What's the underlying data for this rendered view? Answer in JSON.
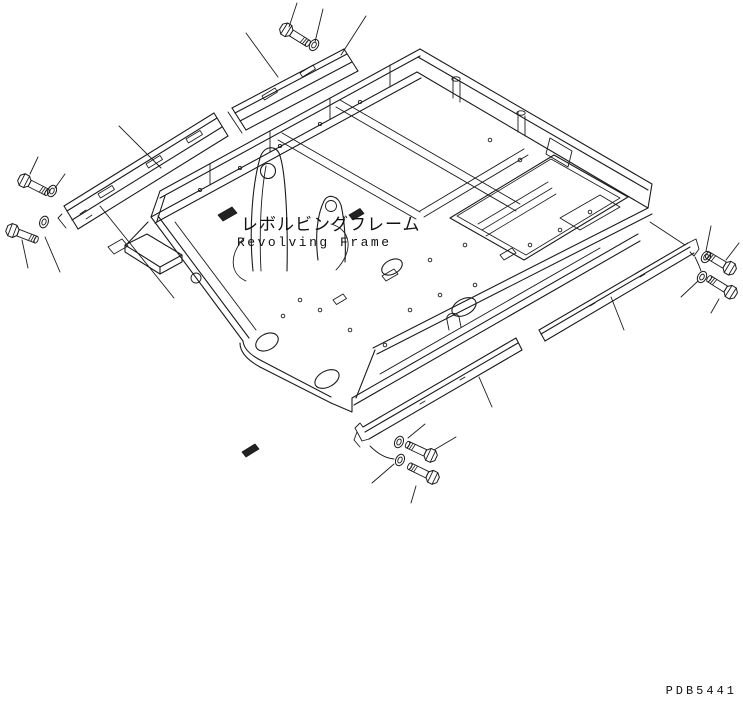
{
  "drawing": {
    "title_ja": "レボルビングフレーム",
    "title_en": "Revolving Frame",
    "code": "PDB5441",
    "background": "#ffffff",
    "line_color": "#1b1b1b",
    "parts_visible": {
      "bolts": 7,
      "washers": 7,
      "detached_rails": 2,
      "side_strips": 2
    }
  }
}
